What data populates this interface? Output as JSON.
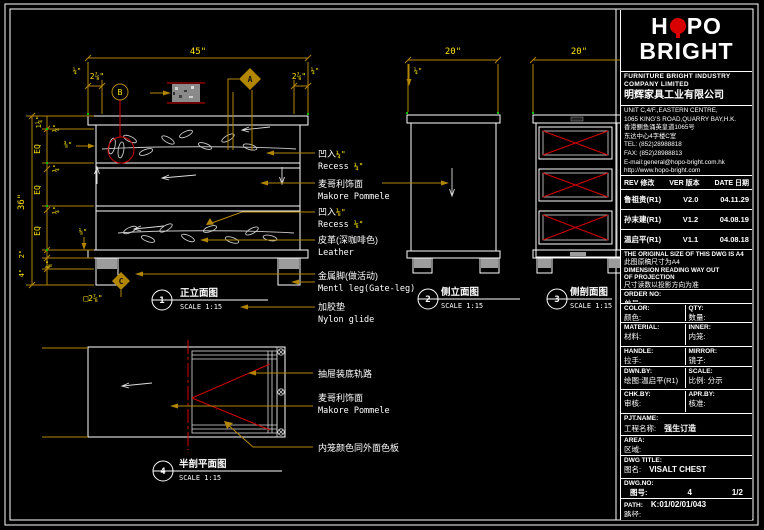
{
  "title_block": {
    "logo": {
      "pre": "H",
      "post": "PO",
      "line2": "BRIGHT"
    },
    "company": {
      "en1": "FURNITURE BRIGHT INDUSTRY",
      "en2": "COMPANY LIMITED",
      "cn": "明辉家具工业有限公司"
    },
    "address": [
      "UNIT C,4/F.,EASTERN CENTRE,",
      "1065 KING'S ROAD,QUARRY BAY,H.K.",
      "香港鲗鱼涌英皇道1065号",
      "东达中心4字楼C室",
      "TEL: (852)28988818",
      "FAX: (852)28988813",
      "E-mail:general@hopo-bright.com.hk",
      "http://www.hopo-bright.com"
    ],
    "rev_header": {
      "rev": "REV 修改",
      "ver": "VER 版本",
      "date": "DATE 日期"
    },
    "revisions": [
      {
        "name": "鲁祖贵(R1)",
        "ver": "V2.0",
        "date": "04.11.29"
      },
      {
        "name": "孙末建(R1)",
        "ver": "V1.2",
        "date": "04.08.19"
      },
      {
        "name": "温启平(R1)",
        "ver": "V1.1",
        "date": "04.08.18"
      }
    ],
    "notes": [
      "THE ORIGINAL SIZE OF THIS DWG IS A4",
      "此图原稿尺寸为A4",
      "DIMENSION READING WAY OUT",
      "OF PROJECTION",
      "尺寸读数以投影方向为准"
    ],
    "fields": {
      "order_en": "ORDER NO:",
      "order_cn": "单号:",
      "color_en": "COLOR:",
      "color_cn": "颜色:",
      "qty_en": "QTY:",
      "qty_cn": "数量:",
      "material_en": "MATERIAL:",
      "material_cn": "材料:",
      "inner_en": "INNER:",
      "inner_cn": "内笼:",
      "handle_en": "HANDLE:",
      "handle_cn": "拉手:",
      "mirror_en": "MIRROR:",
      "mirror_cn": "镜子:",
      "dwn_en": "DWN.BY:",
      "dwn_cn": "绘图:温启平(R1)",
      "scale_en": "SCALE:",
      "scale_cn": "比例: 分示",
      "chk_en": "CHK.BY:",
      "chk_cn": "审核:",
      "apr_en": "APR.BY:",
      "apr_cn": "核准:",
      "pjt_en": "PJT.NAME:",
      "pjt_cn": "工程名称:",
      "pjt_val": "强生订造",
      "area_en": "AREA:",
      "area_cn": "区域:",
      "title_en": "DWG TITLE:",
      "title_cn": "图名:",
      "title_val": "VISALT CHEST",
      "no_en": "DWG.NO:",
      "no_cn": "图号:",
      "no_val": "4",
      "no_page": "1/2",
      "path_en": "PATH:",
      "path_cn": "路径:",
      "path_val": "K:01/02/01/043"
    }
  },
  "views": [
    {
      "no": "1",
      "title": "正立面图",
      "scale": "SCALE 1:15"
    },
    {
      "no": "2",
      "title": "侧立面图",
      "scale": "SCALE 1:15"
    },
    {
      "no": "3",
      "title": "侧剖面图",
      "scale": "SCALE 1:15"
    },
    {
      "no": "4",
      "title": "半剖平面图",
      "scale": "SCALE 1:15"
    }
  ],
  "markers": {
    "a": "A",
    "b": "B",
    "c": "C"
  },
  "drawing": {
    "dims": {
      "front_width": "45\"",
      "front_sub_l": "2⅞\"",
      "front_corner_l": "¼\"",
      "front_sub_r": "2⅞\"",
      "front_corner_r": "¼\"",
      "height": "36\"",
      "top_gap": "1¼\"",
      "eq": "EQ",
      "part": "¾\"",
      "recess_a": "⅜\"",
      "recess_b": "⅛\"",
      "leg_depth": "2\"",
      "leg_height": "4\"",
      "glide": "⅝\"",
      "leg_section": "□2⅞\"",
      "side_width": "20\"",
      "side_corner": "¼\"",
      "section_width": "20\""
    }
  },
  "annotations": {
    "a1": {
      "cn": "凹入",
      "en": "Recess ",
      "dim": "¼\""
    },
    "a2": {
      "cn": "麦哥利饰面",
      "en": "Makore Pommele"
    },
    "a3": {
      "cn": "凹入",
      "en": "Recess ",
      "dim": "⅛\""
    },
    "a4": {
      "cn": "皮革(深咖啡色)",
      "en": "Leather"
    },
    "a5": {
      "cn": "金属脚(做活动)",
      "en": "Mentl leg(Gate-leg)"
    },
    "a6": {
      "cn": "加胶垫",
      "en": "Nylon glide"
    },
    "a7": {
      "cn": "抽屉装底轨路"
    },
    "a8": {
      "cn": "麦哥利饰面",
      "en": "Makore Pommele"
    },
    "a9": {
      "cn": "内笼颜色同外面色板"
    }
  },
  "colors": {
    "dim_line": "#b38600",
    "dim_text": "#ffe400",
    "alert": "#d40000",
    "line": "#ffffff",
    "logo_red": "#d80000",
    "glide_gray": "#9c9c9c"
  }
}
